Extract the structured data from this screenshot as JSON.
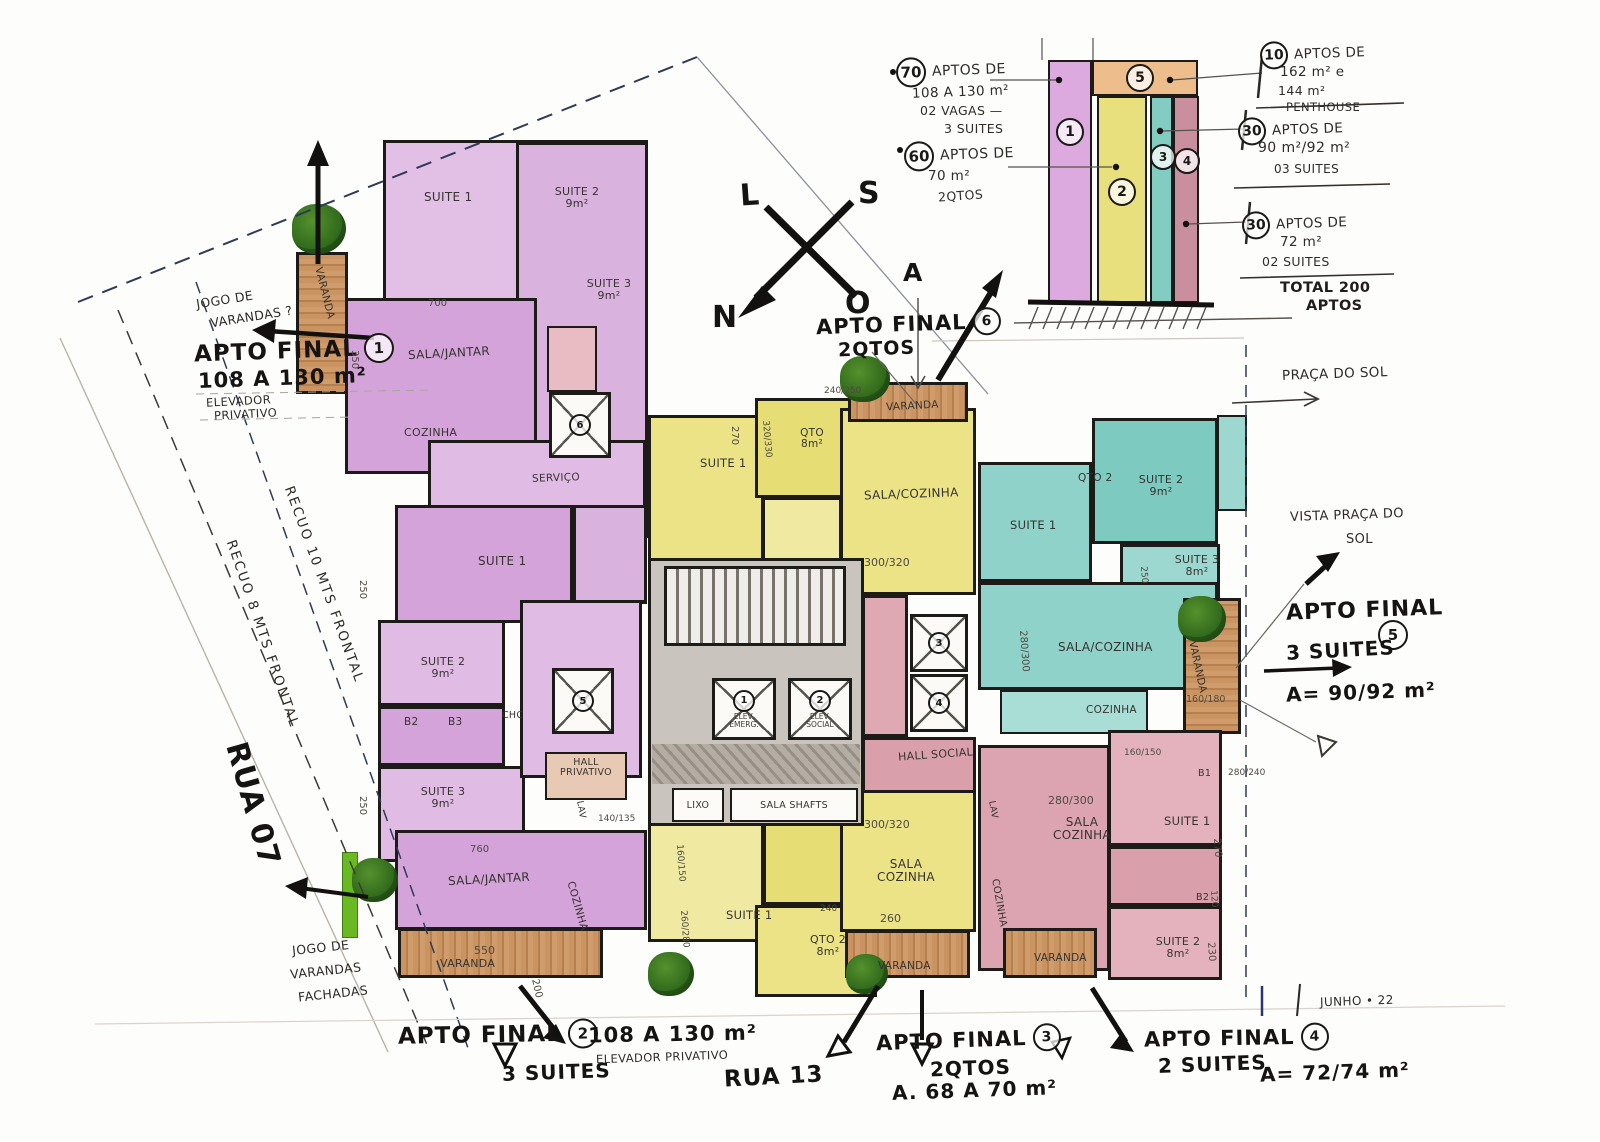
{
  "compass": {
    "l": "L",
    "s": "S",
    "n": "N",
    "o": "O",
    "a": "A"
  },
  "callouts": {
    "a1": {
      "title": "APTO FINAL",
      "num": "1",
      "area": "108 A 130 m²",
      "sub1": "ELEVADOR",
      "sub2": "PRIVATIVO",
      "note1": "JOGO DE",
      "note2": "VARANDAS ?"
    },
    "a2": {
      "title": "APTO FINAL",
      "num": "2",
      "suites": "3 SUITES",
      "area": "108 A 130 m²",
      "sub": "ELEVADOR PRIVATIVO"
    },
    "a3": {
      "title": "APTO FINAL",
      "num": "3",
      "rooms": "2QTOS",
      "area": "A. 68 A 70 m²"
    },
    "a4": {
      "title": "APTO FINAL",
      "num": "4",
      "suites": "2 SUITES",
      "area": "A= 72/74 m²"
    },
    "a5": {
      "title": "APTO FINAL",
      "num": "5",
      "suites": "3 SUITES",
      "area": "A= 90/92 m²",
      "vista1": "VISTA PRAÇA DO",
      "vista2": "SOL"
    },
    "a6": {
      "title": "APTO FINAL",
      "num": "6",
      "rooms": "2QTOS"
    }
  },
  "streets": {
    "rua07": "RUA 07",
    "rua13": "RUA 13",
    "praca": "PRAÇA DO SOL"
  },
  "setbacks": {
    "r10": "RECUO 10 MTS FRONTAL",
    "r8": "RECUO 8 MTS FRONTAL",
    "jogo1": "JOGO DE",
    "jogo2": "VARANDAS",
    "jogo3": "FACHADAS"
  },
  "date_note": "JUNHO • 22",
  "tower": {
    "units": {
      "u1": "1",
      "u2": "2",
      "u3": "3",
      "u4": "4",
      "u5": "5"
    },
    "n70": {
      "c": "70",
      "l1": "APTOS DE",
      "l2": "108 A 130 m²",
      "l3": "02 VAGAS —",
      "l4": "3 SUITES"
    },
    "n60": {
      "c": "60",
      "l1": "APTOS DE",
      "l2": "70 m²",
      "l3": "2QTOS"
    },
    "n10": {
      "c": "10",
      "l1": "APTOS DE",
      "l2": "162 m² e",
      "l3": "144 m²",
      "l4": "PENTHOUSE"
    },
    "n30a": {
      "c": "30",
      "l1": "APTOS DE",
      "l2": "90 m²/92 m²",
      "l3": "03 SUITES"
    },
    "n30b": {
      "c": "30",
      "l1": "APTOS DE",
      "l2": "72 m²",
      "l3": "02 SUITES"
    },
    "total1": "TOTAL 200",
    "total2": "APTOS"
  },
  "core": {
    "n1": "1",
    "n2": "2",
    "n3": "3",
    "n4": "4",
    "n5": "5",
    "n6": "6",
    "elev1a": "ELEV.",
    "elev1b": "EMERG.",
    "elev2a": "ELEV.",
    "elev2b": "SOCIAL",
    "lixo": "LIXO",
    "shafts": "SALA SHAFTS",
    "hall_social": "HALL SOCIAL"
  },
  "rooms": {
    "a1": {
      "suite1": "SUITE 1",
      "suite2": "SUITE 2 9m²",
      "suite3": "SUITE 3 9m²",
      "sala": "SALA/JANTAR",
      "coz": "COZINHA",
      "servico": "SERVIÇO",
      "varanda": "VARANDA"
    },
    "a2": {
      "suite1": "SUITE 1",
      "suite2": "SUITE 2 9m²",
      "b2": "B2",
      "b3": "B3",
      "suite3": "SUITE 3 9m²",
      "sala": "SALA/JANTAR",
      "coz": "COZINHA",
      "chc": "CHC",
      "lav": "LAV",
      "hall": "HALL PRIVATIVO",
      "varanda": "VARANDA"
    },
    "y6": {
      "suite1": "SUITE 1",
      "qto": "QTO 8m²",
      "sala": "SALA/COZINHA",
      "varanda": "VARANDA"
    },
    "y3": {
      "suite1": "SUITE 1",
      "qto2": "QTO 2 8m²",
      "sala": "SALA COZINHA",
      "varanda": "VARANDA"
    },
    "t5": {
      "suite1": "SUITE 1",
      "qto2": "QTO 2",
      "suite2": "SUITE 2 9m²",
      "suite3": "SUITE 3 8m²",
      "sala": "SALA/COZINHA",
      "coz": "COZINHA",
      "varanda": "VARANDA"
    },
    "p4": {
      "sala": "SALA COZINHA",
      "suite1": "SUITE 1",
      "suite2": "SUITE 2 8m²",
      "b1": "B1",
      "b2": "B2",
      "coz": "COZINHA",
      "lav": "LAV",
      "varanda": "VARANDA"
    }
  },
  "dims": {
    "d350": "350",
    "d250a": "250",
    "d250b": "250",
    "d700": "700",
    "d760": "760",
    "d550": "550",
    "d200": "200",
    "d140135": "140/135",
    "d160150a": "160/150",
    "d160150b": "160/150",
    "d260280": "260/280",
    "d300320a": "300/320",
    "d300320b": "300/320",
    "d280300a": "280/300",
    "d280300b": "280/300",
    "d160180": "160/180",
    "d260": "260",
    "d270a": "270",
    "d270b": "270",
    "d230": "230",
    "d240250": "240/250",
    "d320330": "320/330",
    "d240": "240",
    "d250c": "250",
    "d120": "120",
    "d280240": "280/240"
  },
  "colors": {
    "purple": "#d4a3da",
    "yellow": "#e8e07c",
    "teal": "#8fd2c9",
    "pink": "#d9a0ac",
    "orange": "#edbd8b",
    "wood": "#c99462",
    "ink": "#1d1b18"
  }
}
